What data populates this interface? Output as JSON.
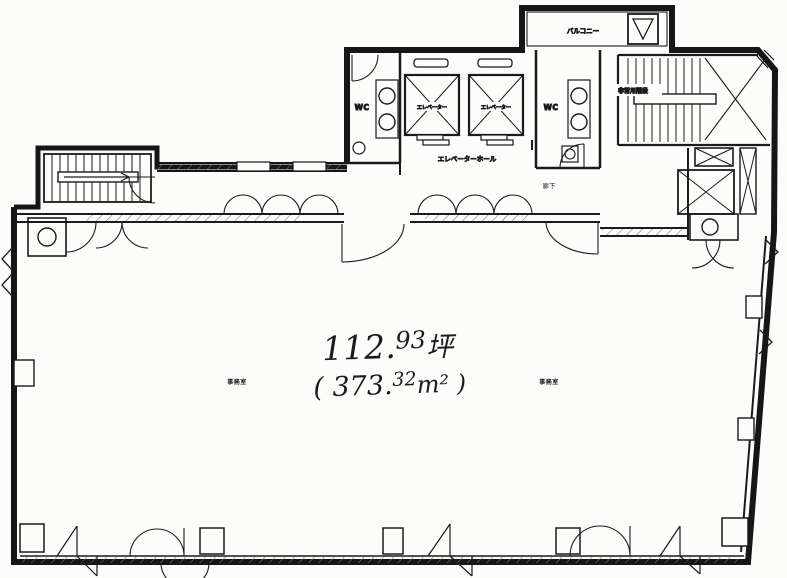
{
  "plan": {
    "area": {
      "tsubo_int": "112.",
      "tsubo_sup": "93",
      "tsubo_unit": "坪",
      "m2_open": "( 373.",
      "m2_sup": "32",
      "m2_close": "m² )"
    },
    "labels": {
      "elevator_left": "エレベーター",
      "elevator_right": "エレベーター",
      "elevator_hall": "エレベーターホール",
      "wc_left": "WC",
      "wc_right": "WC",
      "balcony": "バルコニー",
      "emergency_stairs": "非常用階段",
      "corridor": "廊下",
      "office_left": "事務室",
      "office_right": "事務室"
    }
  }
}
